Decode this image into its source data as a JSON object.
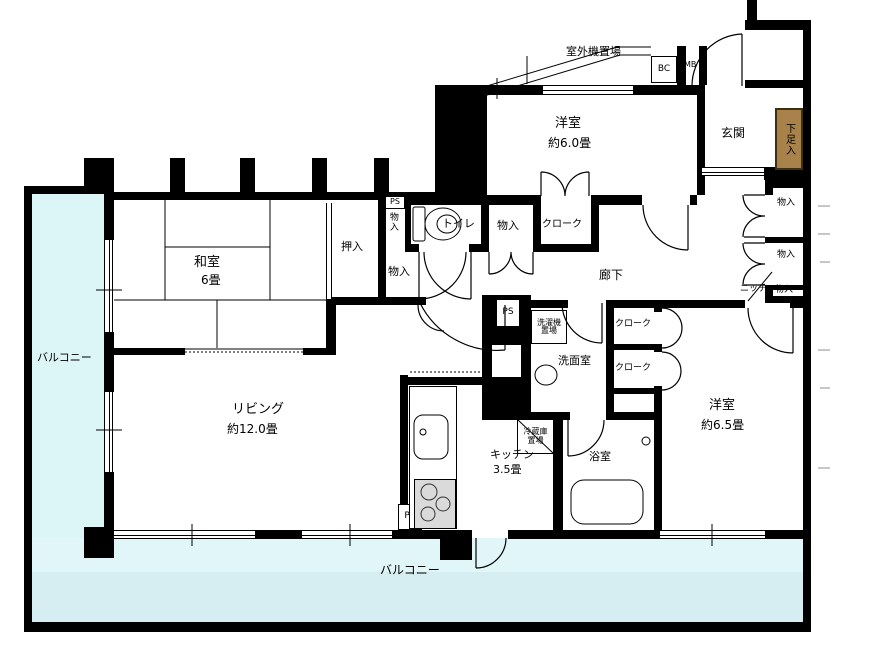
{
  "plan": {
    "balconies": {
      "left": "バルコニー",
      "bottom": "バルコニー"
    },
    "rooms": {
      "western_6": {
        "name": "洋室",
        "size": "約6.0畳"
      },
      "western_65": {
        "name": "洋室",
        "size": "約6.5畳"
      },
      "japanese": {
        "name": "和室",
        "size": "6畳"
      },
      "living": {
        "name": "リビング",
        "size": "約12.0畳"
      },
      "kitchen": {
        "name": "キッチン",
        "size": "3.5畳"
      },
      "entrance": "玄関",
      "hallway": "廊下",
      "toilet": "トイレ",
      "washroom": "洗面室",
      "bathroom": "浴室",
      "outdoor_unit_area": "室外機置場"
    },
    "storage": {
      "oshiire": "押入",
      "shoe_cabinet": "下足入",
      "cloak_north": "クローク",
      "cloak_east_upper": "クローク",
      "cloak_east_lower": "クローク",
      "closet_side": "物入",
      "closet_mid": "物入",
      "closet_passage": "物入",
      "closet_east_1": "物入",
      "closet_east_2": "物入",
      "closet_east_3": "物入",
      "niche": "ニッチ",
      "washer_space": {
        "line1": "洗濯機",
        "line2": "置場"
      },
      "fridge_space": {
        "line1": "冷蔵庫",
        "line2": "置場"
      }
    },
    "utilities": {
      "ps_north": "PS",
      "ps_center": "PS",
      "ps_kitchen": "PS",
      "bc": "BC",
      "mb": "MB"
    },
    "colors": {
      "wall": "#000000",
      "balcony_left": "#dcf6f8",
      "balcony_bottom": "#d6edf2",
      "shoe_cabinet": "#a8824a",
      "stove": "#dadada"
    }
  }
}
